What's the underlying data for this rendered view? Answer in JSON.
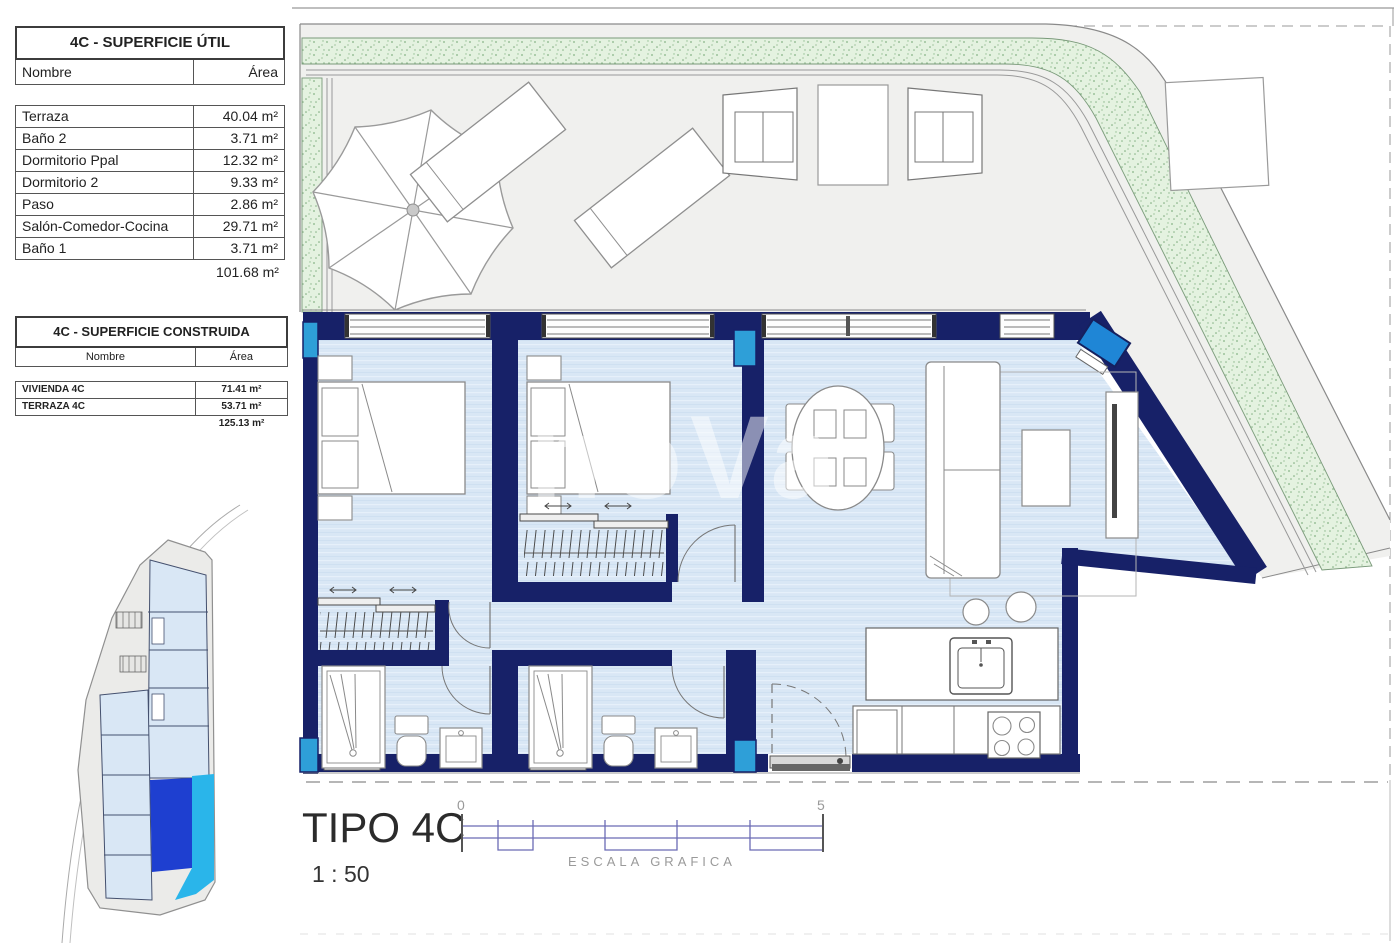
{
  "document": {
    "type_label": "TIPO 4C",
    "scale_label": "1 : 50"
  },
  "scale_bar": {
    "start_label": "0",
    "end_label": "5",
    "caption": "ESCALA GRAFICA"
  },
  "watermark": "noVa",
  "tables": {
    "superficie_util": {
      "title": "4C - SUPERFICIE ÚTIL",
      "columns": {
        "name": "Nombre",
        "area": "Área"
      },
      "rows": [
        {
          "name": "Terraza",
          "area": "40.04 m²"
        },
        {
          "name": "Baño 2",
          "area": "3.71 m²"
        },
        {
          "name": "Dormitorio Ppal",
          "area": "12.32 m²"
        },
        {
          "name": "Dormitorio 2",
          "area": "9.33 m²"
        },
        {
          "name": "Paso",
          "area": "2.86 m²"
        },
        {
          "name": "Salón-Comedor-Cocina",
          "area": "29.71 m²"
        },
        {
          "name": "Baño 1",
          "area": "3.71 m²"
        }
      ],
      "total": "101.68 m²"
    },
    "superficie_construida": {
      "title": "4C - SUPERFICIE CONSTRUIDA",
      "columns": {
        "name": "Nombre",
        "area": "Área"
      },
      "rows": [
        {
          "name": "VIVIENDA 4C",
          "area": "71.41 m²"
        },
        {
          "name": "TERRAZA 4C",
          "area": "53.71 m²"
        }
      ],
      "total": "125.13 m²"
    }
  },
  "plan_colors": {
    "wall_navy": "#172168",
    "floor_blue": "#d9e7f5",
    "terrace_gray": "#f0f0ee",
    "planting_green": "#e4f2e0",
    "column_cyan": "#2e9fd8",
    "ac_unit_blue": "#1f86d6",
    "keyplan_vivienda_blue": "#1e3fd0",
    "keyplan_terraza_cyan": "#2ab5ea",
    "scalebar_blue": "#6b6bb5"
  }
}
